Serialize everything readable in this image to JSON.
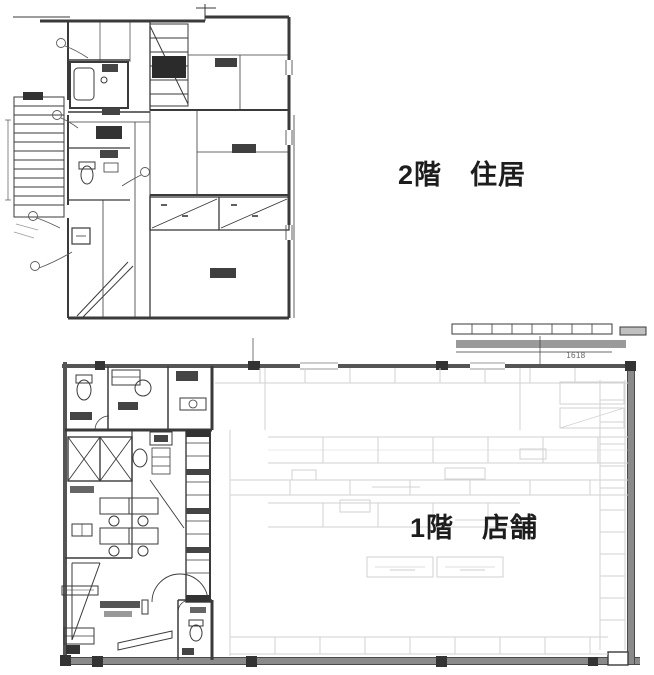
{
  "page": {
    "type": "architectural-floor-plan",
    "background": "#ffffff"
  },
  "floors": {
    "second": {
      "label": "2階　住居"
    },
    "first": {
      "label": "1階　店舗",
      "canopy_dimension": "1618"
    }
  },
  "colors": {
    "ink": "#3a3a3a",
    "wall_gray": "#8a8a8a",
    "canopy_gray": "#9a9a9a",
    "fixture_light": "#d2d2d2",
    "label_text": "#1d1d1d"
  },
  "icons": {
    "toilet": "toilet-fixture",
    "stairs": "staircase",
    "closet_cross": "closet-diagonal",
    "shelving": "store-shelf-rows"
  }
}
